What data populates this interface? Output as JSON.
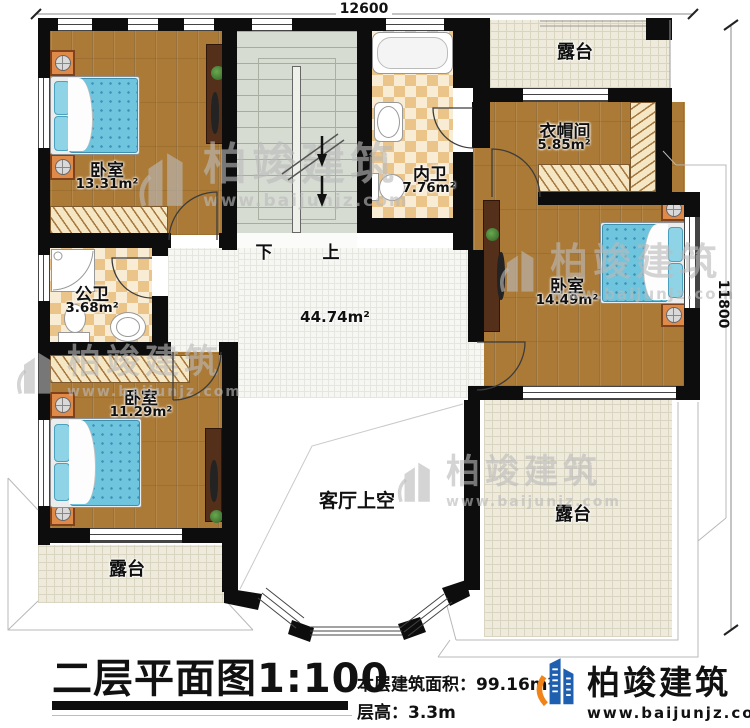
{
  "dims": {
    "width": "12600",
    "height": "11800"
  },
  "stair": {
    "down": "下",
    "up": "上"
  },
  "rooms": {
    "bedroom_tl": {
      "name": "卧室",
      "area": "13.31m²"
    },
    "bedroom_bl": {
      "name": "卧室",
      "area": "11.29m²"
    },
    "bedroom_r": {
      "name": "卧室",
      "area": "14.49m²"
    },
    "bath_private": {
      "name": "内卫",
      "area": "7.76m²"
    },
    "bath_public": {
      "name": "公卫",
      "area": "3.68m²"
    },
    "cloakroom": {
      "name": "衣帽间",
      "area": "5.85m²"
    },
    "hall": {
      "area": "44.74m²"
    },
    "void": {
      "name": "客厅上空"
    },
    "terrace_top": {
      "name": "露台"
    },
    "terrace_bl": {
      "name": "露台"
    },
    "terrace_br": {
      "name": "露台"
    }
  },
  "footer": {
    "title": "二层平面图",
    "scale": "1:100",
    "area_label": "本层建筑面积：",
    "area_value": "99.16m²",
    "height_label": "层高：",
    "height_value": "3.3m"
  },
  "brand": {
    "name": "柏竣建筑",
    "site": "www.baijunjz.com"
  },
  "watermark": {
    "name": "柏竣建筑",
    "site": "www.baijunjz.com"
  },
  "colors": {
    "wall": "#0d0d0d",
    "wood_floor": "#ab7a36",
    "stair_floor": "#d6dcd2",
    "terrace_tile": "#eeeadc",
    "bath_tile_a": "#eac488",
    "bath_tile_b": "#f8ecd4",
    "bed_blue": "#6fc4de",
    "nightstand_orange": "#e08a4a",
    "brand_blue": "#1f5fb0",
    "brand_orange": "#f08418"
  }
}
